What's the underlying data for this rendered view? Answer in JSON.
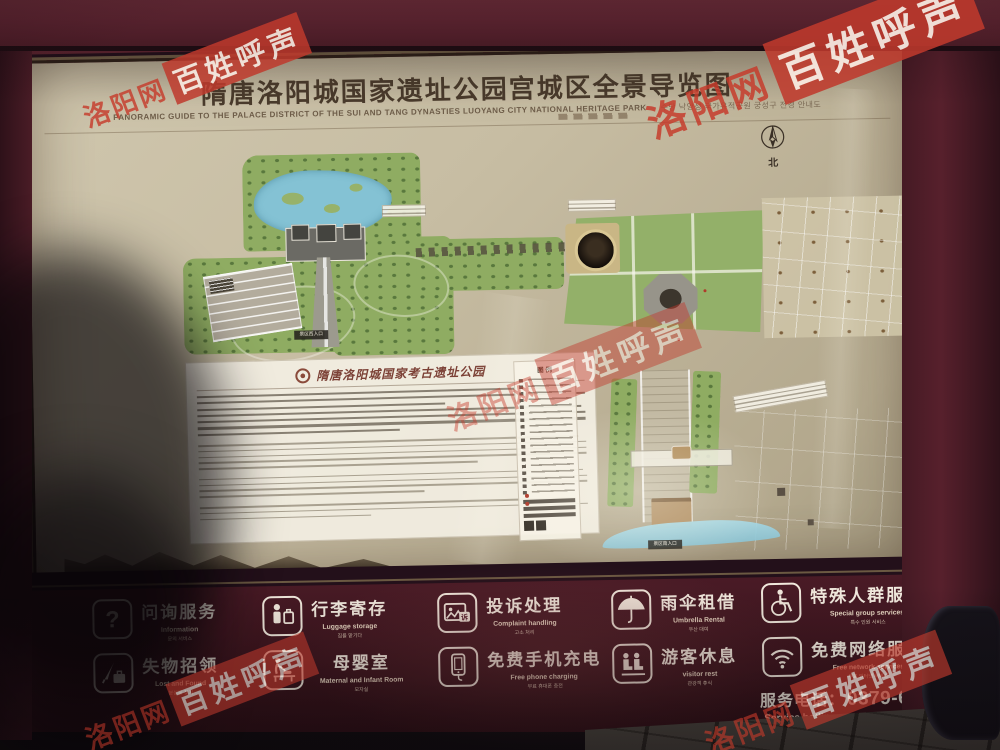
{
  "watermark": {
    "site": "洛阳网",
    "slogan": "百姓呼声"
  },
  "board": {
    "title": "隋唐洛阳城国家遗址公园宫城区全景导览图",
    "subtitle_en": "PANORAMIC GUIDE TO THE PALACE DISTRICT OF THE SUI AND TANG DYNASTIES LUOYANG CITY NATIONAL HERITAGE PARK",
    "subtitle_ko": "수당 낙양성 국가유적공원 궁성구 전경 안내도",
    "compass": "北"
  },
  "map": {
    "intro_title": "隋唐洛阳城国家考古遗址公园",
    "legend_title": "图 例",
    "west_entrance": "景区西入口",
    "south_entrance": "景区南入口"
  },
  "services": {
    "items": [
      {
        "id": "information",
        "zh": "问询服务",
        "en": "Information",
        "ko": "문의 서비스"
      },
      {
        "id": "lost-found",
        "zh": "失物招领",
        "en": "Lost and Found",
        "ko": "분실물 찾기"
      },
      {
        "id": "luggage",
        "zh": "行李寄存",
        "en": "Luggage storage",
        "ko": "짐을 맡기다"
      },
      {
        "id": "mother-baby",
        "zh": "母婴室",
        "en": "Maternal and Infant Room",
        "ko": "모자실"
      },
      {
        "id": "complaint",
        "zh": "投诉处理",
        "en": "Complaint handling",
        "ko": "고소 처리",
        "icon_char": "诉"
      },
      {
        "id": "phone-charge",
        "zh": "免费手机充电",
        "en": "Free phone charging",
        "ko": "무료 휴대폰 충전"
      },
      {
        "id": "umbrella",
        "zh": "雨伞租借",
        "en": "Umbrella Rental",
        "ko": "우산 대여"
      },
      {
        "id": "visitor-rest",
        "zh": "游客休息",
        "en": "visitor rest",
        "ko": "관광객 휴식"
      },
      {
        "id": "special",
        "zh": "特殊人群服务",
        "en": "Special group services",
        "ko": "특수 인원 서비스"
      },
      {
        "id": "wifi",
        "zh": "免费网络服务",
        "en": "Free network services",
        "ko": "무료 인터넷 서비스"
      }
    ],
    "hotline": {
      "label": "服务电话：",
      "number": "0379-65063201",
      "en": "Service hotline",
      "ko": "서비스 전화"
    }
  },
  "colors": {
    "board_maroon": "#57212d",
    "panel_beige": "#c7bda3",
    "watermark_red": "#bf3a2c",
    "map_green": "#8fac62",
    "lake_blue": "#84c2d4"
  }
}
